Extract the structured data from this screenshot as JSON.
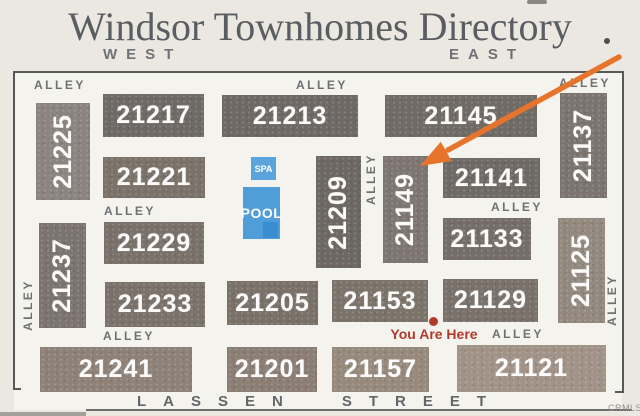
{
  "sign": {
    "title": "Windsor Townhomes Directory",
    "west_label": "WEST",
    "east_label": "EAST",
    "street_word1": "LASSEN",
    "street_word2": "STREET",
    "watermark": "CRMLS",
    "title_color": "#5a5e63",
    "background_color": "#ebe8e1"
  },
  "map": {
    "alley_text": "ALLEY",
    "border_color": "#57585a",
    "building_number_color": "#fcfbfa",
    "buildings": [
      {
        "label": "21225",
        "orient": "v",
        "x": 36,
        "y": 103,
        "w": 54,
        "h": 97,
        "color": "#8b8480"
      },
      {
        "label": "21217",
        "orient": "h",
        "x": 103,
        "y": 94,
        "w": 101,
        "h": 43,
        "color": "#6f6a66"
      },
      {
        "label": "21213",
        "orient": "h",
        "x": 222,
        "y": 95,
        "w": 136,
        "h": 42,
        "color": "#6e6965"
      },
      {
        "label": "21145",
        "orient": "h",
        "x": 385,
        "y": 95,
        "w": 152,
        "h": 42,
        "color": "#716b66"
      },
      {
        "label": "21137",
        "orient": "v",
        "x": 560,
        "y": 93,
        "w": 47,
        "h": 105,
        "color": "#7c756f"
      },
      {
        "label": "21221",
        "orient": "h",
        "x": 103,
        "y": 157,
        "w": 102,
        "h": 41,
        "color": "#7b7269"
      },
      {
        "label": "21209",
        "orient": "v",
        "x": 316,
        "y": 156,
        "w": 45,
        "h": 112,
        "color": "#6d6862"
      },
      {
        "label": "21149",
        "orient": "v",
        "x": 383,
        "y": 156,
        "w": 45,
        "h": 107,
        "color": "#7e7671"
      },
      {
        "label": "21141",
        "orient": "h",
        "x": 443,
        "y": 158,
        "w": 97,
        "h": 40,
        "color": "#6f6a66"
      },
      {
        "label": "21229",
        "orient": "h",
        "x": 104,
        "y": 222,
        "w": 100,
        "h": 42,
        "color": "#79716a"
      },
      {
        "label": "21133",
        "orient": "h",
        "x": 443,
        "y": 218,
        "w": 88,
        "h": 42,
        "color": "#756e68"
      },
      {
        "label": "21237",
        "orient": "v",
        "x": 39,
        "y": 223,
        "w": 47,
        "h": 105,
        "color": "#7c746e"
      },
      {
        "label": "21125",
        "orient": "v",
        "x": 558,
        "y": 218,
        "w": 47,
        "h": 105,
        "color": "#93897f"
      },
      {
        "label": "21233",
        "orient": "h",
        "x": 105,
        "y": 282,
        "w": 100,
        "h": 45,
        "color": "#7b726b"
      },
      {
        "label": "21205",
        "orient": "h",
        "x": 227,
        "y": 281,
        "w": 91,
        "h": 44,
        "color": "#7a7169"
      },
      {
        "label": "21153",
        "orient": "h",
        "x": 332,
        "y": 280,
        "w": 96,
        "h": 42,
        "color": "#7c736b"
      },
      {
        "label": "21129",
        "orient": "h",
        "x": 443,
        "y": 279,
        "w": 95,
        "h": 43,
        "color": "#7a716a"
      },
      {
        "label": "21241",
        "orient": "h",
        "x": 40,
        "y": 347,
        "w": 152,
        "h": 45,
        "color": "#8e8278"
      },
      {
        "label": "21201",
        "orient": "h",
        "x": 227,
        "y": 347,
        "w": 90,
        "h": 45,
        "color": "#8a7e75"
      },
      {
        "label": "21157",
        "orient": "h",
        "x": 332,
        "y": 347,
        "w": 97,
        "h": 45,
        "color": "#968a7d"
      },
      {
        "label": "21121",
        "orient": "h",
        "x": 457,
        "y": 345,
        "w": 149,
        "h": 47,
        "color": "#a29388"
      }
    ],
    "alleys": [
      {
        "orient": "h",
        "x": 34,
        "y": 78
      },
      {
        "orient": "h",
        "x": 296,
        "y": 78
      },
      {
        "orient": "h",
        "x": 559,
        "y": 76
      },
      {
        "orient": "h",
        "x": 104,
        "y": 204
      },
      {
        "orient": "h",
        "x": 491,
        "y": 200
      },
      {
        "orient": "h",
        "x": 103,
        "y": 329
      },
      {
        "orient": "h",
        "x": 492,
        "y": 327
      },
      {
        "orient": "v",
        "x": 28,
        "y": 305
      },
      {
        "orient": "v",
        "x": 371,
        "y": 179
      },
      {
        "orient": "v",
        "x": 612,
        "y": 300
      }
    ],
    "amenities": {
      "spa": {
        "label": "SPA",
        "color": "#5aa3dd"
      },
      "pool": {
        "label": "POOL",
        "color": "#4f9ed9",
        "tab_color": "#3a8ecf"
      }
    },
    "you_are_here": {
      "label": "You Are Here",
      "color": "#b3392f"
    },
    "arrow": {
      "color": "#e7742c",
      "x1": 619,
      "y1": 57,
      "x2": 448,
      "y2": 150,
      "head_points": "420,166 440.8,141.8 451.6,161"
    }
  }
}
